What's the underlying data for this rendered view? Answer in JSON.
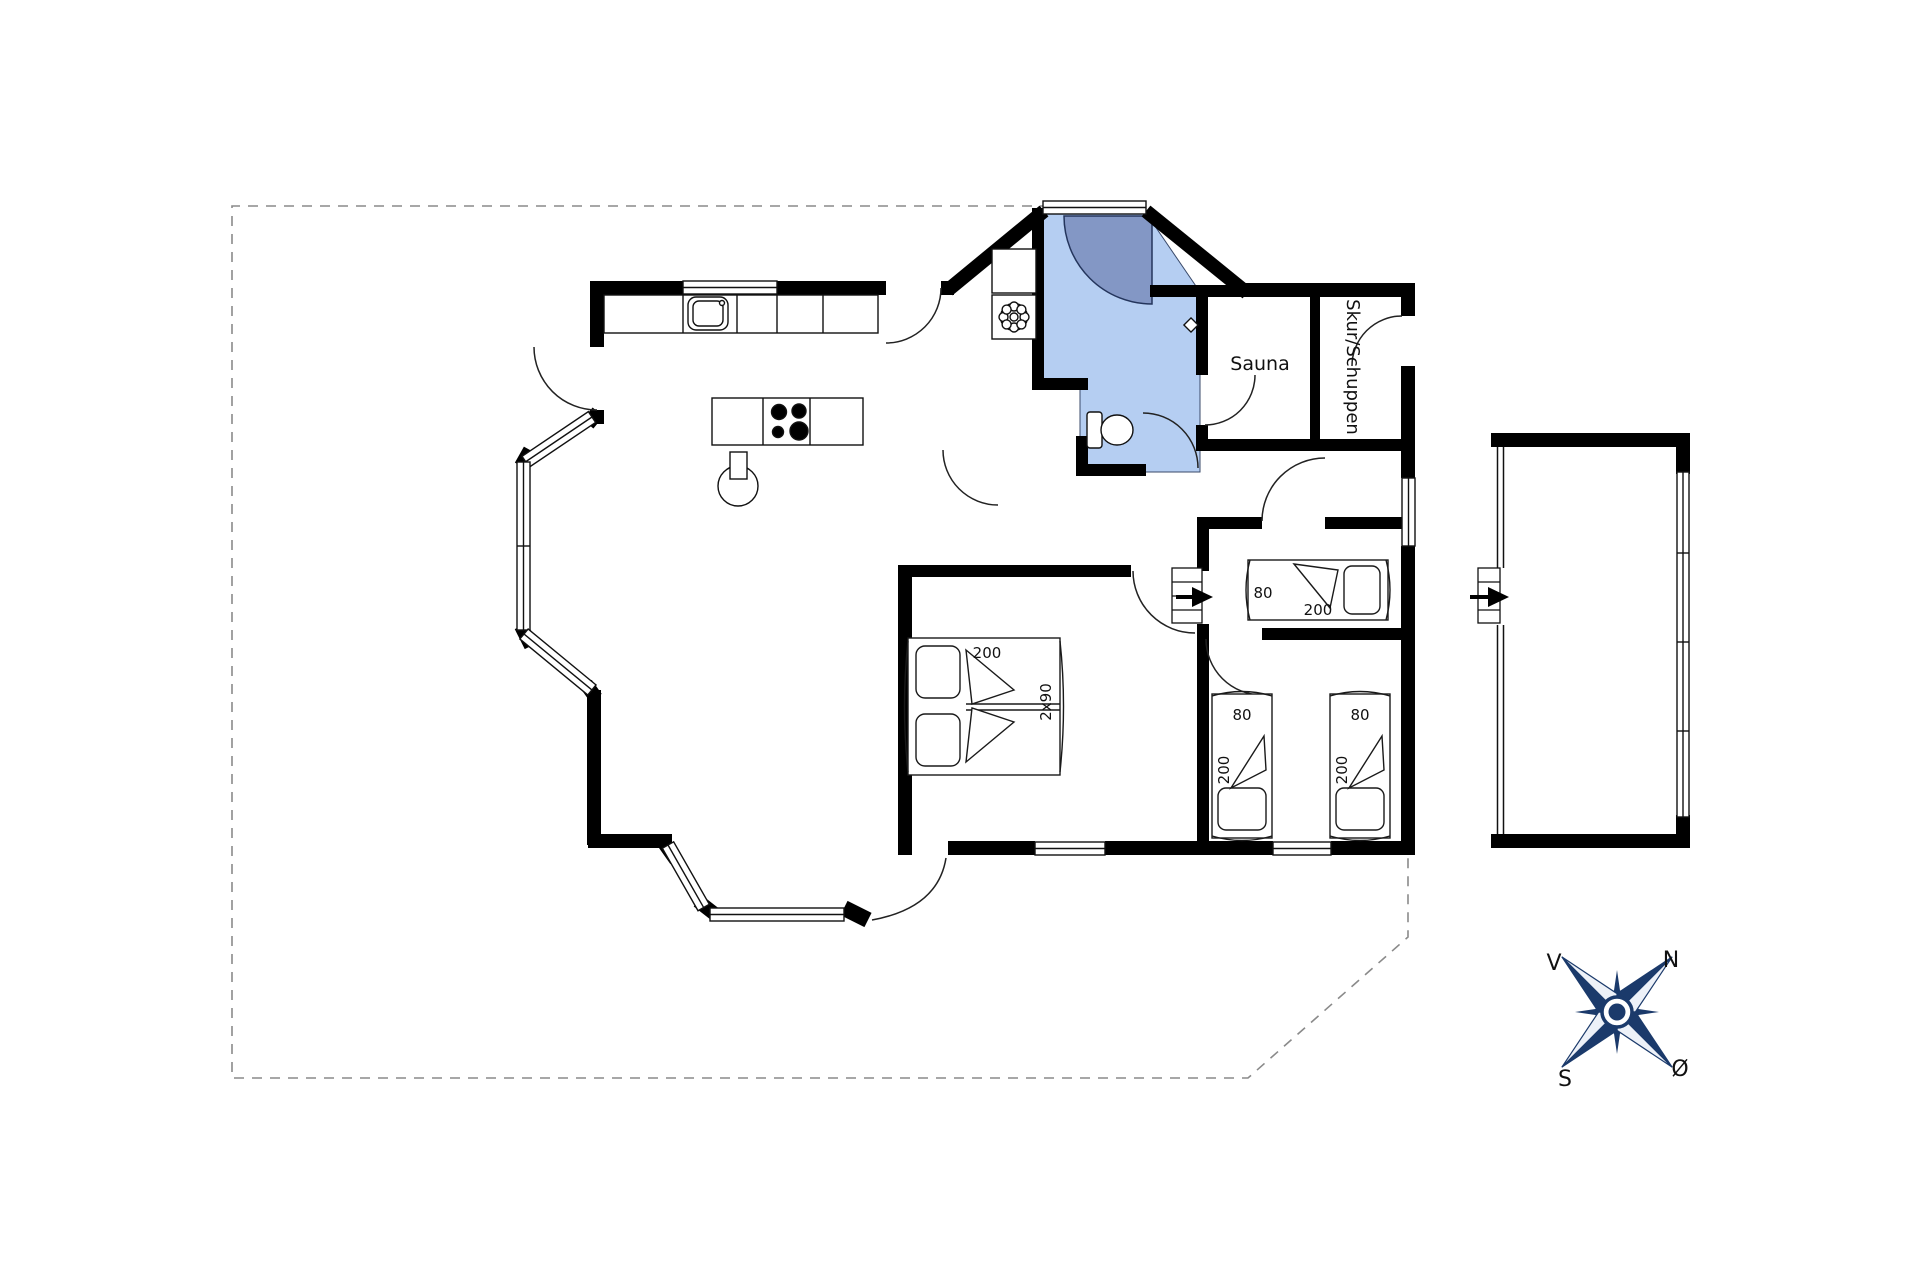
{
  "document": {
    "type": "holiday-house floor plan"
  },
  "labels": {
    "sauna": "Sauna",
    "shed": "Skur/Schuppen"
  },
  "beds": {
    "double": {
      "length_label": "200",
      "width_label": "2x90"
    },
    "hall_single": {
      "width_label": "80",
      "length_label": "200"
    },
    "kids_left": {
      "width_label": "80",
      "length_label": "200"
    },
    "kids_right": {
      "width_label": "80",
      "length_label": "200"
    }
  },
  "compass": {
    "north": "N",
    "east": "Ø",
    "south": "S",
    "west": "V"
  },
  "colors": {
    "wall": "#000000",
    "bath_floor": "#b5cef2",
    "shower": "#8397c5",
    "compass_navy": "#1b3a6b",
    "boundary_dash": "#8a8a8a",
    "background": "#ffffff"
  }
}
